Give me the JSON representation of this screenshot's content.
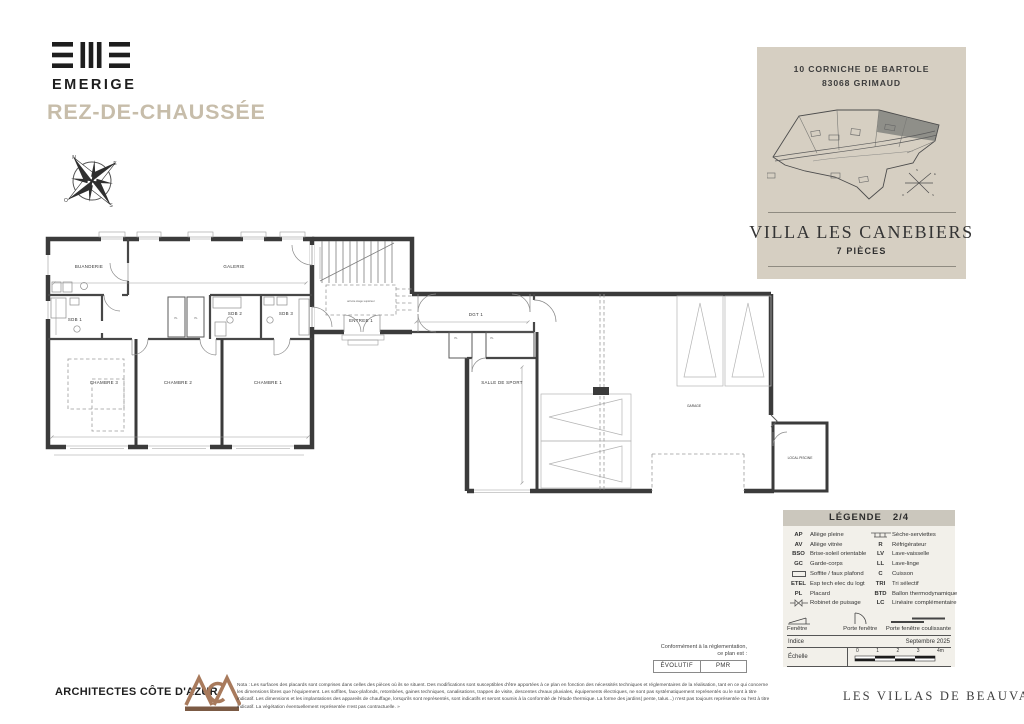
{
  "brand": {
    "name": "EMERIGE"
  },
  "page_title": "REZ-DE-CHAUSSÉE",
  "compass": {
    "n": "N",
    "e": "E",
    "s": "S",
    "o": "O"
  },
  "project_card": {
    "address_line1": "10 CORNICHE DE BARTOLE",
    "address_line2": "83068 GRIMAUD",
    "villa_name": "VILLA LES CANEBIERS",
    "rooms_count": "7 PIÈCES"
  },
  "floorplan": {
    "rooms": [
      "BUANDERIE",
      "GALERIE",
      "SDB 1",
      "SDB 2",
      "SDB 3",
      "CHAMBRE 3",
      "CHAMBRE 2",
      "CHAMBRE 1",
      "ENTREE 1",
      "DGT 1",
      "SALLE DE SPORT",
      "GARAGE",
      "LOCAL PISCINE"
    ],
    "stair_note": "arrivée étage supérieur",
    "pl_label": "PL"
  },
  "legend": {
    "title": "LÉGENDE",
    "page": "2/4",
    "left_items": [
      {
        "abbr": "AP",
        "label": "Allège pleine"
      },
      {
        "abbr": "AV",
        "label": "Allège vitrée"
      },
      {
        "abbr": "BSO",
        "label": "Brise-soleil orientable"
      },
      {
        "abbr": "GC",
        "label": "Garde-corps"
      },
      {
        "abbr": "",
        "label": "Soffite / faux plafond"
      },
      {
        "abbr": "ETEL",
        "label": "Esp tech elec du logt"
      },
      {
        "abbr": "PL",
        "label": "Placard"
      },
      {
        "abbr": "",
        "label": "Robinet de puisage"
      }
    ],
    "right_items": [
      {
        "abbr": "",
        "label": "Sèche-serviettes"
      },
      {
        "abbr": "R",
        "label": "Réfrigérateur"
      },
      {
        "abbr": "LV",
        "label": "Lave-vaisselle"
      },
      {
        "abbr": "LL",
        "label": "Lave-linge"
      },
      {
        "abbr": "C",
        "label": "Cuisson"
      },
      {
        "abbr": "TRI",
        "label": "Tri sélectif"
      },
      {
        "abbr": "BTD",
        "label": "Ballon thermodynamique"
      },
      {
        "abbr": "LC",
        "label": "Linéaire complémentaire"
      }
    ],
    "window_symbols": [
      "Fenêtre",
      "Porte fenêtre",
      "Porte fenêtre coulissante"
    ],
    "indice_label": "Indice",
    "indice_value": "Septembre 2025",
    "echelle_label": "Échelle",
    "scale_ticks": [
      "0",
      "1",
      "2",
      "3",
      "4m"
    ]
  },
  "compliance": {
    "note_line1": "Conformément à la réglementation,",
    "note_line2": "ce plan est :",
    "buttons": [
      "ÉVOLUTIF",
      "PMR"
    ]
  },
  "footer": {
    "architect": "ARCHITECTES CÔTE D'AZUR",
    "nota": "Nota : Les surfaces des placards sont comprises dans celles des pièces où ils se situent. Des modifications sont susceptibles d'être apportées à ce plan en fonction des nécessités techniques et réglementaires de la réalisation, tant en ce qui concerne les dimensions libres que l'équipement. Les soffites, faux-plafonds, retombées, gaines techniques, canalisations, trappes de visite, descentes d'eaux pluviales, équipements électriques, ne sont pas systématiquement représentés ou le sont à titre indicatif. Les dimensions et les implantations des appareils de chauffage, lorsqu'ils sont représentés, sont indicatifs et seront soumis à la conformité de l'étude thermique. La forme des jardins( pente, talus...) n'est pas toujours représentée ou l'est à titre indicatif. La végétation éventuellement représentée n'est pas contractuelle. »",
    "project_brand": "LES VILLAS DE BEAUVALLON"
  },
  "colors": {
    "card_beige": "#d6cfc2",
    "title_taupe": "#c7bdaa",
    "wall_dark": "#3b3b3b",
    "legend_header": "#cbc7bd",
    "aca_copper": "#a87a5c"
  }
}
